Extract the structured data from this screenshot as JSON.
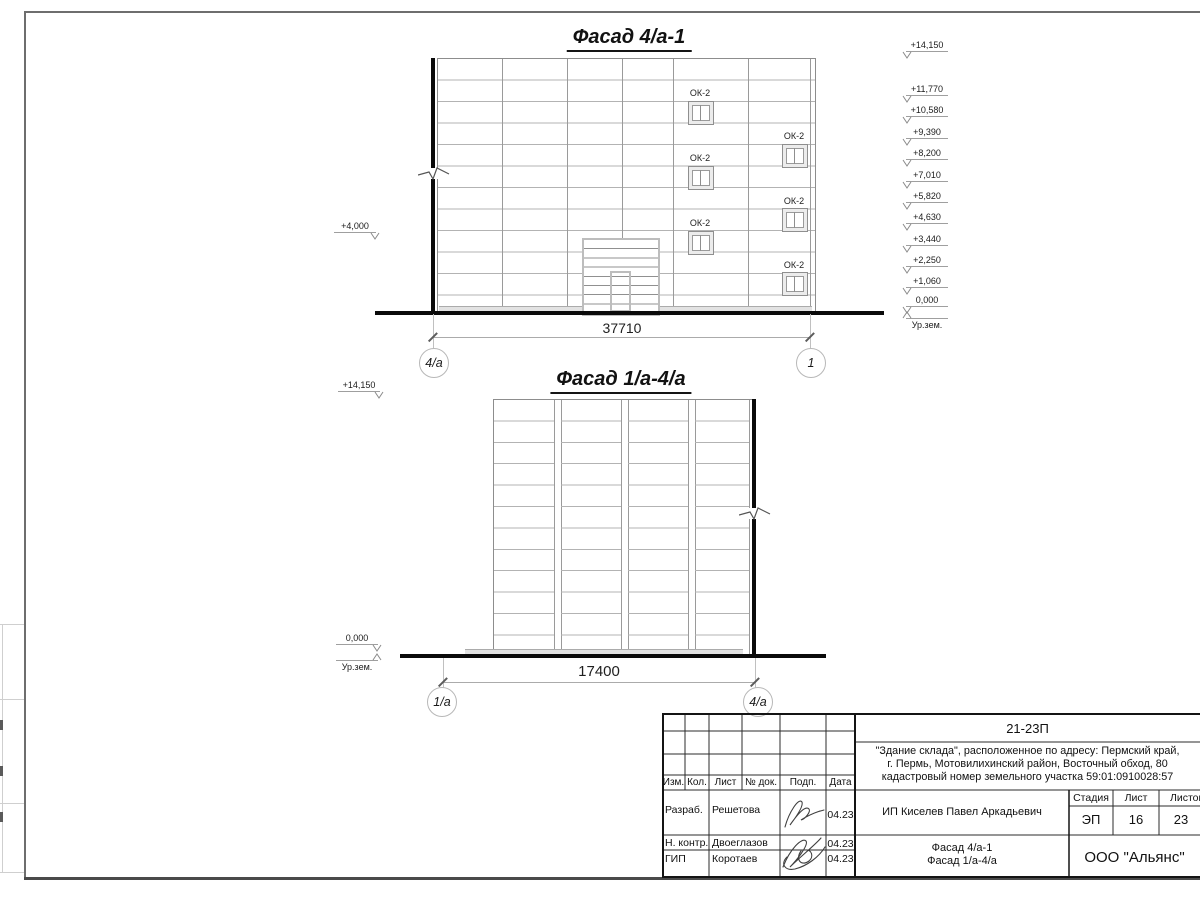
{
  "sheet": {
    "facade1": {
      "title": "Фасад 4/а-1",
      "left_mark": "+4,000",
      "right_marks": [
        "+14,150",
        "+11,770",
        "+10,580",
        "+9,390",
        "+8,200",
        "+7,010",
        "+5,820",
        "+4,630",
        "+3,440",
        "+2,250",
        "+1,060",
        "0,000"
      ],
      "ground_level_label": "Ур.зем.",
      "window_label": "ОК-2",
      "dimension": "37710",
      "axis_left": "4/а",
      "axis_right": "1"
    },
    "facade2": {
      "title": "Фасад 1/а-4/а",
      "top_mark": "+14,150",
      "zero_mark": "0,000",
      "ground_level_label": "Ур.зем.",
      "dimension": "17400",
      "axis_left": "1/а",
      "axis_right": "4/а"
    },
    "stamp": {
      "doc_number": "21-23П",
      "address_line1": "\"Здание склада\", расположенное по адресу: Пермский край,",
      "address_line2": "г. Пермь, Мотовилихинский район, Восточный обход, 80",
      "address_line3": "кадастровый номер земельного участка 59:01:0910028:57",
      "client": "ИП Киселев Павел Аркадьевич",
      "col_izm": "Изм.",
      "col_kol": "Кол.",
      "col_list": "Лист",
      "col_doc": "№ док.",
      "col_podp": "Подп.",
      "col_data": "Дата",
      "row1_role": "Разраб.",
      "row1_name": "Решетова",
      "row1_date": "04.23",
      "row2_role": "Н. контр.",
      "row2_name": "Двоеглазов",
      "row2_date": "04.23",
      "row3_role": "ГИП",
      "row3_name": "Коротаев",
      "row3_date": "04.23",
      "stage_header": "Стадия",
      "sheet_header": "Лист",
      "sheets_header": "Листов",
      "stage": "ЭП",
      "sheet_num": "16",
      "sheets_total": "23",
      "title_line1": "Фасад 4/а-1",
      "title_line2": "Фасад 1/а-4/а",
      "company": "ООО \"Альянс\""
    }
  }
}
